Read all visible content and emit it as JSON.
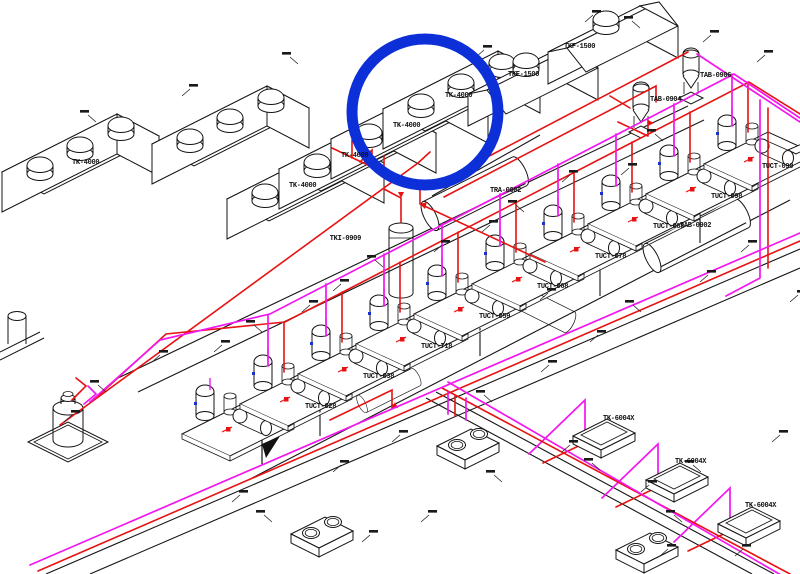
{
  "diagram": {
    "type": "isometric-piping-plot-plan",
    "colors": {
      "pipe_red": "#e81212",
      "pipe_magenta": "#f316ef",
      "linework_black": "#151515",
      "highlight_blue": "#0d2fd8"
    },
    "equipment": {
      "storage_tanks": [
        "TK-4000",
        "TK-4000",
        "TK-4000",
        "TK-4000",
        "TK-4000"
      ],
      "roofed_tanks": {
        "tke": "TKE-1500",
        "tkf": "TKF-1500"
      },
      "feed_hoppers": [
        "TAB-0904",
        "TAB-0906"
      ],
      "column": "TKI-0909",
      "drum": "TRA-0002",
      "horizontal_tank": "TAB-0902",
      "dosing_skids": [
        "TUCT-028",
        "TUCT-038",
        "TUCT-718",
        "TUCT-059",
        "TUCT-068",
        "TUCT-078",
        "TUCT-088",
        "TUCT-098",
        "TUCT-090"
      ],
      "enclosures": [
        "TK-6004X",
        "TK-6004X",
        "TK-6004X"
      ]
    },
    "annotation": {
      "shape": "circle",
      "color": "#0d2fd8"
    }
  }
}
